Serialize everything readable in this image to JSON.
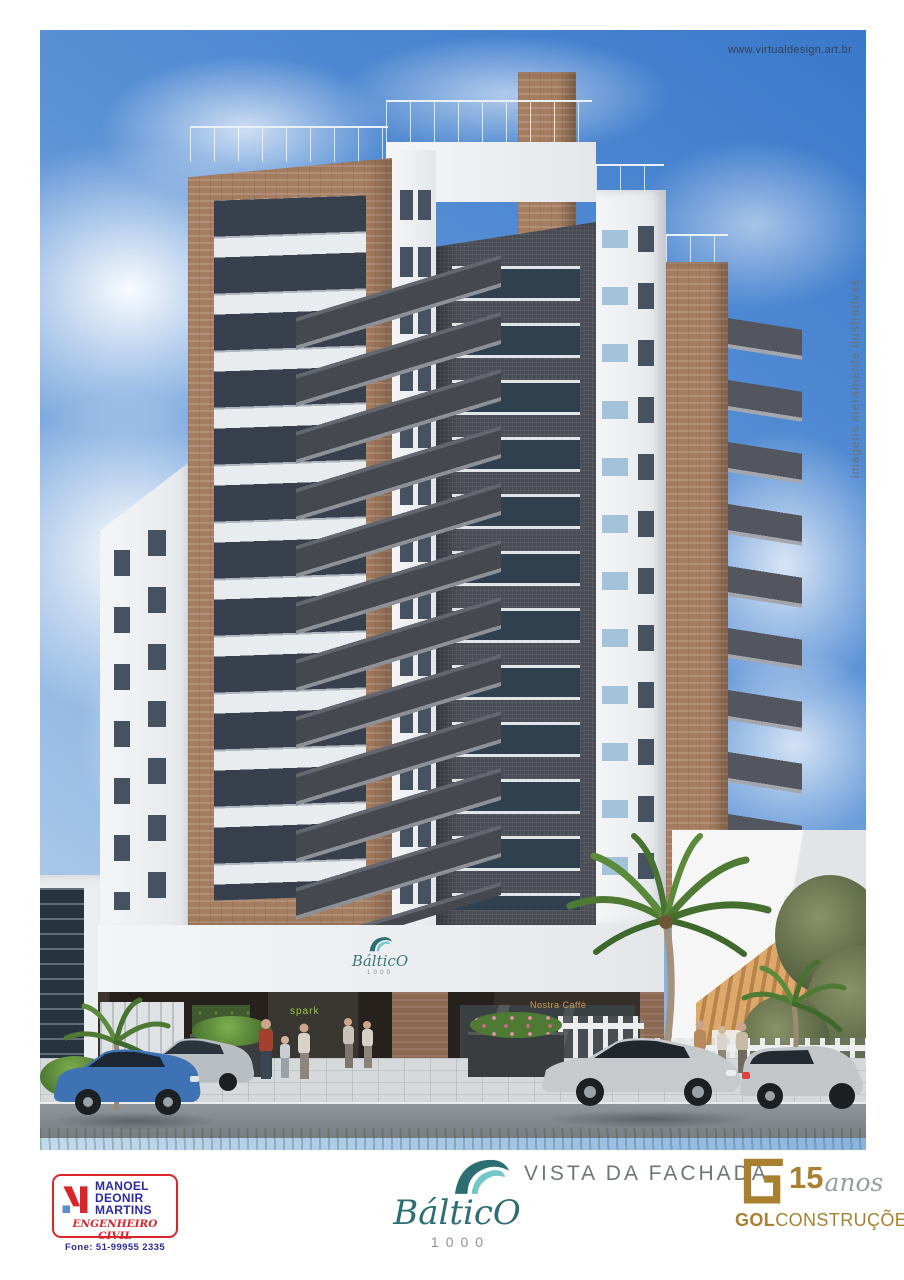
{
  "poster": {
    "watermark": "www.virtualdesign.art.br",
    "disclaimer": "imagens meramente ilustrativas",
    "caption": "VISTA DA FACHADA"
  },
  "building_signs": {
    "facade_brand": "BálticO",
    "facade_number": "1000",
    "shop_left": "spark",
    "shop_right": "Nostra Caffè"
  },
  "engineer_stamp": {
    "name_line1": "MANOEL",
    "name_line2": "DEONIR",
    "name_line3": "MARTINS",
    "title": "ENGENHEIRO CIVIL",
    "phone": "Fone: 51-99955 2335",
    "blue": "#2b2aa5",
    "red": "#d9252b"
  },
  "brand_logo": {
    "name": "BálticO",
    "number": "1000",
    "teal_dark": "#2d6e73",
    "teal_light": "#74c7c9",
    "gray": "#8d9296"
  },
  "builder_logo": {
    "years": "15",
    "years_word": "anos",
    "name_bold": "GOL",
    "name_regular": "CONSTRUÇÕES",
    "gold": "#a8802f"
  },
  "scene": {
    "sky_top": "#3a78ca",
    "sky_bottom": "#c3d9ee",
    "brick": "#a57d60",
    "dark_tile": "#4a4d55",
    "facade_white": "#eef0f2"
  }
}
